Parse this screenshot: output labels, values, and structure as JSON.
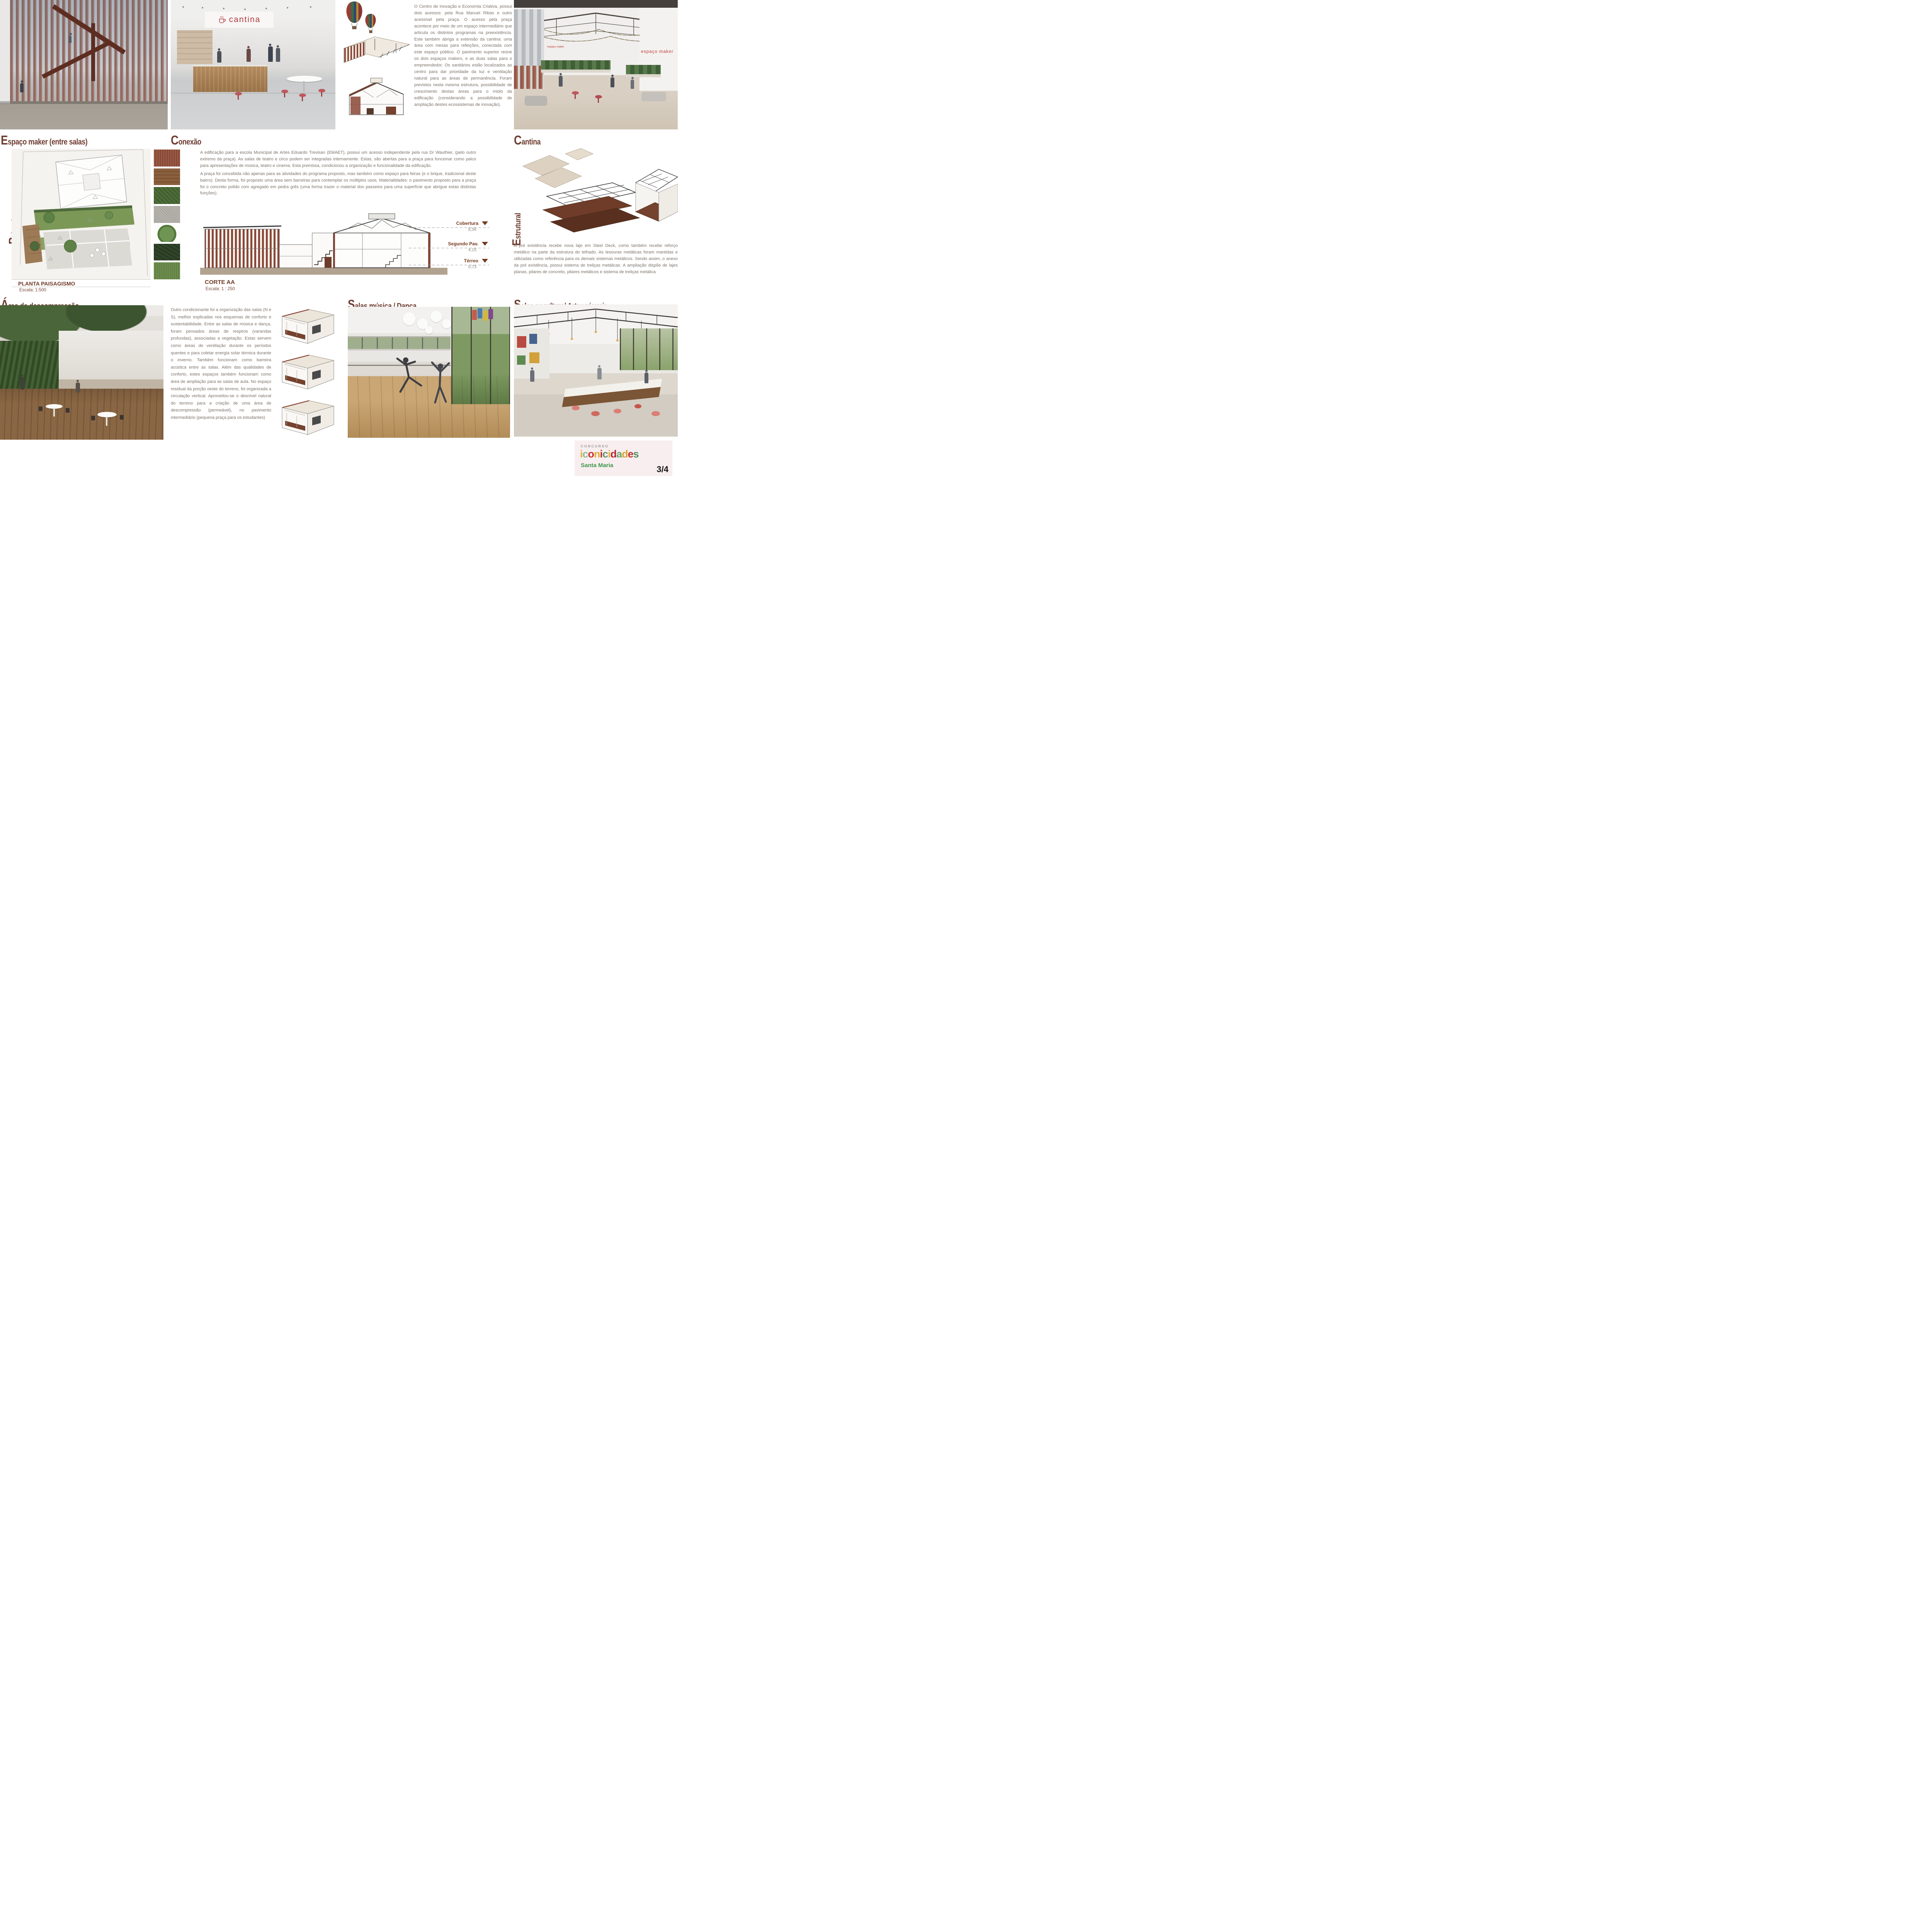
{
  "titles": {
    "espaco_maker": "Espaço maker (entre salas)",
    "conexao": "Conexão",
    "cantina": "Cantina",
    "paisagismo": "Paisagismo",
    "estrutural": "Estrutural",
    "area_descompressao": "Área de descompressão",
    "salas_musica": "Salas música / Dança",
    "salas_escultura": "Salas escultura/ Artes visuais"
  },
  "texts": {
    "cantina_paragraph": "O Centro de Inovação e Economia Criativa, possui dois acessos: pela Rua Manuel Ribas e outro acessível pela praça. O acesso pela praça acontece por meio de um espaço intermediário que articula os distintos programas na preexistência. Este também abriga a extensão da cantina: uma área com mesas para refeições, conectada com este espaço público. O pavimento superior reúne os dois espaços makers, e as duas salas para o empreendedor. Os sanitários estão localizados ao centro para dar prioridade da luz e ventilação natural para as áreas de permanência. Foram previstos nesta mesma estrutura, possibilidade de crescimento destas áreas para o miolo da edificação (considerando a possibilidade de ampliação destes ecossistemas de inovação).",
    "emaet_p1": "A edificação para a escola Municipal de Artes Eduardo Trevisan (EMAET), possui um acesso independente pela rua Dr Wauthier, (pelo outro extremo da praça). As salas de teatro e circo podem ser integradas internamente. Estas, são abertas para a praça para funcionar como palco para apresentações de música, teatro e cinema. Esta premissa, condicionou a organização e funcionalidade da edificação.",
    "emaet_p2": "A praça foi concebida não apenas para as atividades do programa proposto, mas também como espaço para feiras (e o brique, tradicional deste bairro). Desta forma, foi proposto uma área sem barreiras para contemplar os múltiplos usos. Materialidades: o pavimento proposto para a praça foi o concreto polido com agregado em pedra grês (uma forma trazer o material dos passeios para uma superfície que abrigue estas distintas funções).",
    "estrutural_paragraph": "A pré existência recebe nova laje em Steel Deck, como também recebe reforço metálico na parte da estrutura do telhado. As tesouras metálicas foram mantidas e utilizadas como referência para os demais sistemas metálicos. Sendo assim, o anexo da pré existência, possui sistema de treliças metálicas. A ampliação dispõe de lajes planas, pilares de concreto, pilares metálicos e sistema de treliças metálica",
    "descompressao_paragraph": "Outro condicionante foi a organização das salas (N e S), melhor explicadas nos esquemas de conforto e sustentabilidade. Entre as salas de música e dança, foram pensados áreas de respiros (varandas profundas), associadas a vegetação. Estas servem como áreas de ventilação durante os períodos quentes e para coletar energia solar térmica durante o inverno. Também funcionam como barreira acústica entre as salas. Além das qualidades de conforto, estes espaços também funcionam como área de ampliação para as salas de aula. No espaço residual da porção oeste do terreno, foi organizada a circulação vertical. Aproveitou-se o desnível natural do terreno para a criação de uma área de descompressão (permeável), no pavimento intermediário (pequena praça para os estudantes)"
  },
  "drawings": {
    "planta": {
      "title": "PLANTA PAISAGISMO",
      "scale": "Escala: 1:500"
    },
    "corte": {
      "title": "CORTE AA",
      "scale": "Escala: 1 : 250",
      "levels": [
        {
          "name": "Cobertura",
          "value": "8,56"
        },
        {
          "name": "Segundo Pav.",
          "value": "4,15"
        },
        {
          "name": "Térreo",
          "value": "0,73"
        }
      ]
    }
  },
  "signs": {
    "cantina": "cantina",
    "espaco_maker": "espaço maker"
  },
  "footer": {
    "concurso": "CONCURSO",
    "brand": "iconicidades",
    "city": "Santa Maria",
    "page": "3/4",
    "brand_colors": [
      "#e2b33a",
      "#8bbd93",
      "#cf2e31",
      "#e0ad2f",
      "#c32429",
      "#5f9468",
      "#e2b33a",
      "#b7242c",
      "#6aa571",
      "#d9a52e",
      "#c62b2f",
      "#4f8f5e"
    ]
  },
  "colors": {
    "title_brown": "#6e3c30",
    "body_text": "#7b7168",
    "corten": "#8a4736",
    "level_label": "#76391d",
    "sign_red": "#b5353d"
  }
}
